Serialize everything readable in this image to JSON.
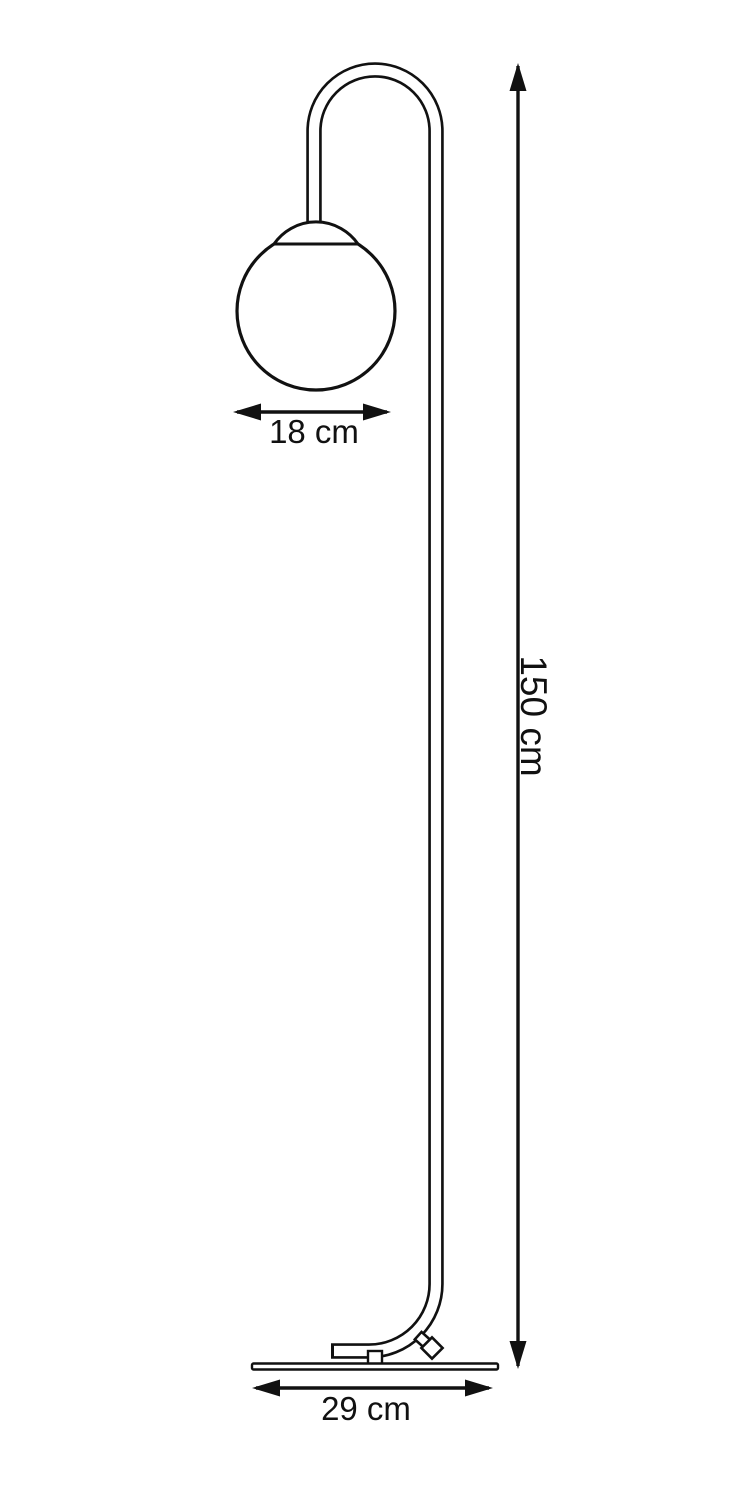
{
  "page": {
    "title": "Floor lamp dimension drawing",
    "background": "#ffffff"
  },
  "colors": {
    "line": "#111111",
    "background": "#ffffff"
  },
  "dimensions": {
    "shade_width_label": "18 cm",
    "height_label": "150 cm",
    "base_width_label": "29 cm"
  }
}
